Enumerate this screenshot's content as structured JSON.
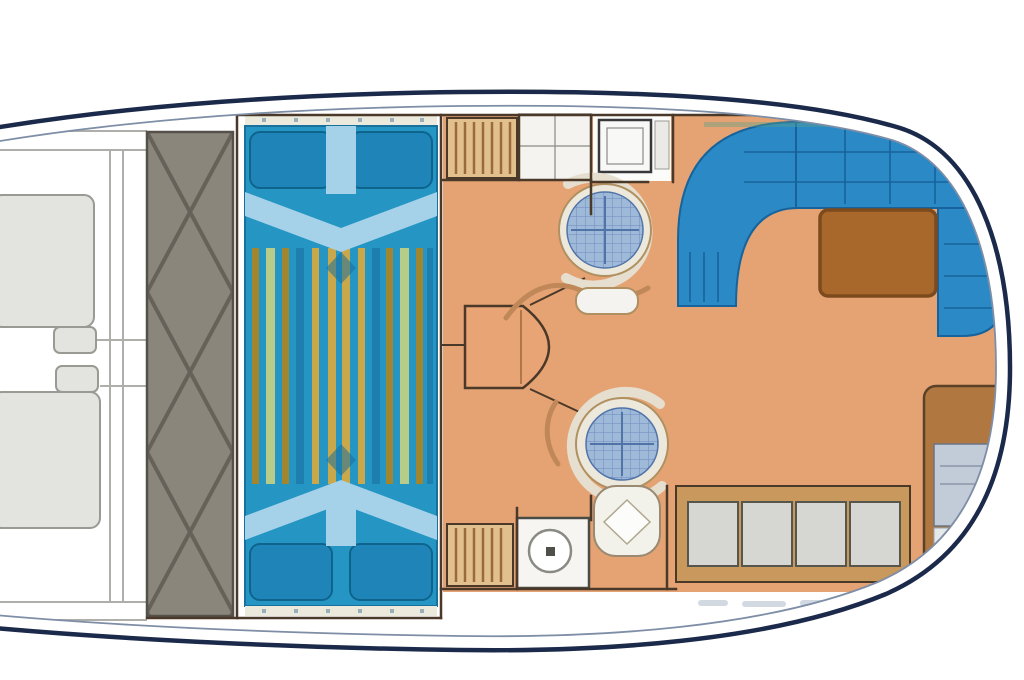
{
  "title": "motor-yacht-interior-deck-plan",
  "canvas": {
    "width": 1024,
    "height": 680
  },
  "colors": {
    "hull_stroke": "#1b2a4a",
    "hull_inner": "#7e8ea6",
    "tread_fill": "#8b867c",
    "tread_line": "#66625a",
    "tread_edge": "#55504a",
    "hatch_fill": "#e3e3df",
    "hatch_stroke": "#9a9a94",
    "rail_gray": "#aeaeaa",
    "wall": "#4a3828",
    "bed_blue": "#2596c4",
    "bed_edge": "#17719c",
    "pillow": "#1f84b8",
    "pillow_edge": "#0f648e",
    "blanket": "#a5d2e8",
    "knot": "#1a6f9e",
    "trim": "#eceadc",
    "trim_dot": "#9ab0b8",
    "stripe_olive": "#a1862f",
    "stripe_green": "#b8cc8a",
    "stripe_gold": "#c8a84b",
    "stripe_teal": "#1e7eae",
    "floor": "#e5a374",
    "console_fill": "#e8a474",
    "sofa": "#2b8ac6",
    "sofa_line": "#17639c",
    "sofa_glow": "#5aa08a",
    "table_brown": "#a8682c",
    "table_edge": "#7c4a1c",
    "ring": "#ece8dc",
    "ring_edge": "#b09060",
    "mosaic": "#9fb9d9",
    "mosaic_grid": "#6d8cc0",
    "mosaic_cross": "#5074a8",
    "crescent": "#e6dfcf",
    "swoosh": "#c08858",
    "white_fix": "#f4f3ef",
    "fix_edge": "#8a8a84",
    "shower_edge": "#38383a",
    "wood": "#e2c08e",
    "slat": "#9a6a38",
    "panel": "#d6d6d2",
    "panel_edge": "#56564e",
    "cab_frame": "#c9985c",
    "stair_frame": "#b07840",
    "stair_panel": "#c2ccd8",
    "stair_lower": "#e6e9ec",
    "stair_line": "#8a96a8",
    "dark_bar": "#3c3c3c",
    "window_tick": "#c3cdd8"
  },
  "regions": {
    "hull": "hull-outline",
    "bow_deck": "bow-deck",
    "hatch_forward": "bow-hatch-forward",
    "hatch_aft": "bow-hatch-aft",
    "tread": "side-deck-tread-strip",
    "cabin": "owner-cabin",
    "bed": "double-bed",
    "wardrobe": "louvered-wardrobe",
    "cabinet_top": "upper-cabinet",
    "shower": "shower-room",
    "console": "helm-console-seat",
    "table_fwd": "mosaic-table-forward",
    "table_aft": "mosaic-table-aft",
    "saloon": "saloon",
    "sofa": "saloon-sofa",
    "coffee_table": "coffee-table",
    "galley": "galley",
    "stove": "galley-stove",
    "sink": "galley-sink",
    "sideboard": "aft-sideboard",
    "stairs": "companionway-stairs"
  }
}
